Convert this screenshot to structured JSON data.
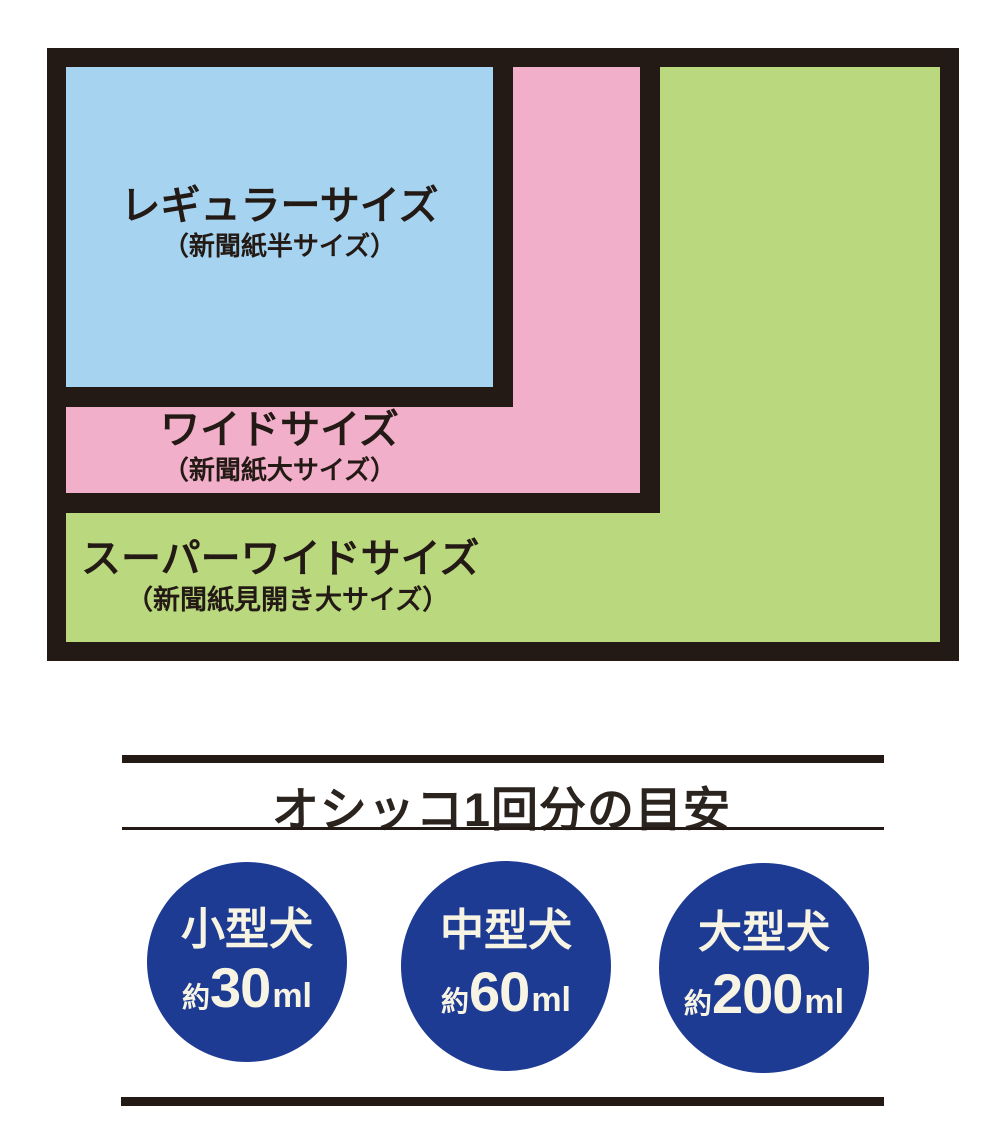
{
  "colors": {
    "frame_black": "#241a15",
    "regular_fill": "#a6d4f0",
    "wide_fill": "#f2afc9",
    "super_wide_fill": "#bad97e",
    "circle_fill": "#1e3b94",
    "circle_text": "#f7f4e3",
    "text_dark": "#241a15",
    "background": "#ffffff"
  },
  "size_diagram": {
    "regular": {
      "title": "レギュラーサイズ",
      "subtitle": "（新聞紙半サイズ）"
    },
    "wide": {
      "title": "ワイドサイズ",
      "subtitle": "（新聞紙大サイズ）"
    },
    "super_wide": {
      "title": "スーパーワイドサイズ",
      "subtitle": "（新聞紙見開き大サイズ）"
    }
  },
  "urine_guide": {
    "heading": "オシッコ1回分の目安",
    "circles": [
      {
        "dog": "小型犬",
        "prefix": "約",
        "amount": "30",
        "unit": "ml"
      },
      {
        "dog": "中型犬",
        "prefix": "約",
        "amount": "60",
        "unit": "ml"
      },
      {
        "dog": "大型犬",
        "prefix": "約",
        "amount": "200",
        "unit": "ml"
      }
    ]
  }
}
